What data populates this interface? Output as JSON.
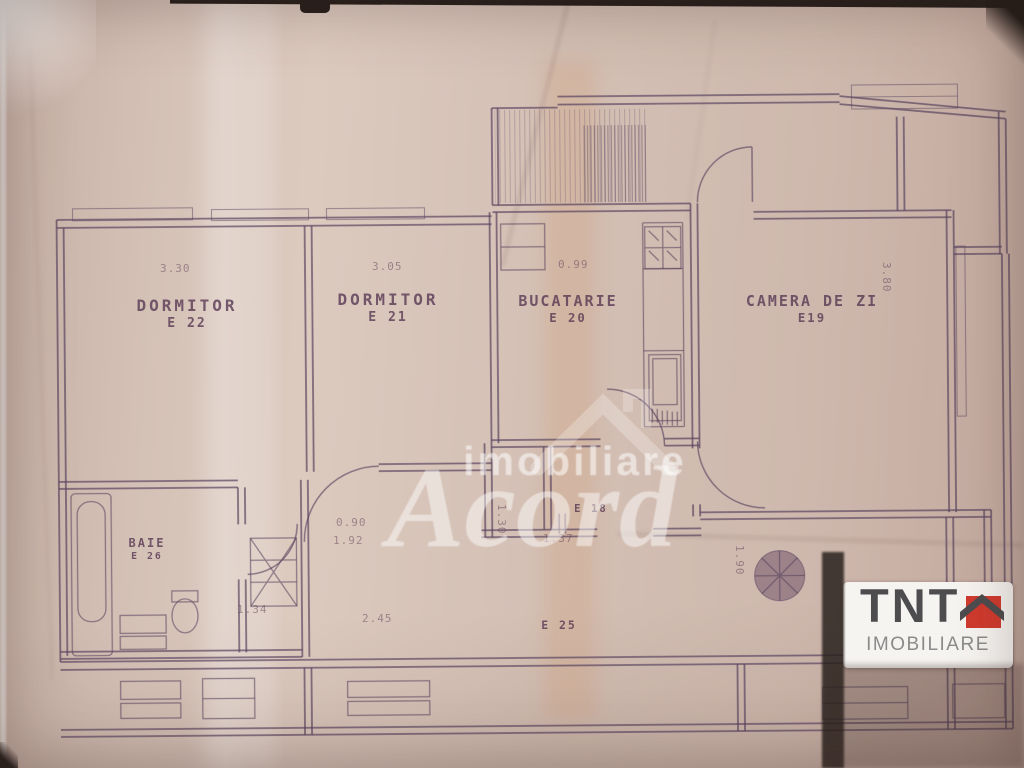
{
  "colors": {
    "paper": "#d2bdb2",
    "ink": "#5a4560",
    "logo_red": "#d03a2e",
    "logo_text": "#4d4c4e",
    "logo_sub": "#8b8b8b",
    "watermark_white": "#ffffff"
  },
  "plan": {
    "rooms": [
      {
        "name": "DORMITOR",
        "code": "E 22"
      },
      {
        "name": "DORMITOR",
        "code": "E 21"
      },
      {
        "name": "BUCATARIE",
        "code": "E 20"
      },
      {
        "name": "CAMERA DE ZI",
        "code": "E19"
      },
      {
        "name": "BAIE",
        "code": "E 26"
      },
      {
        "name": "",
        "code": "E 18"
      },
      {
        "name": "",
        "code": "E 25"
      }
    ],
    "dimensions": [
      "3.30",
      "3.05",
      "0.99",
      "3.80",
      "0.90",
      "1.92",
      "1.30",
      "1.37",
      "2.45",
      "1.34",
      "1.90"
    ]
  },
  "watermark": {
    "top": "imobiliare",
    "main": "Acord"
  },
  "logo": {
    "title": "TNT",
    "subtitle": "IMOBILIARE"
  }
}
